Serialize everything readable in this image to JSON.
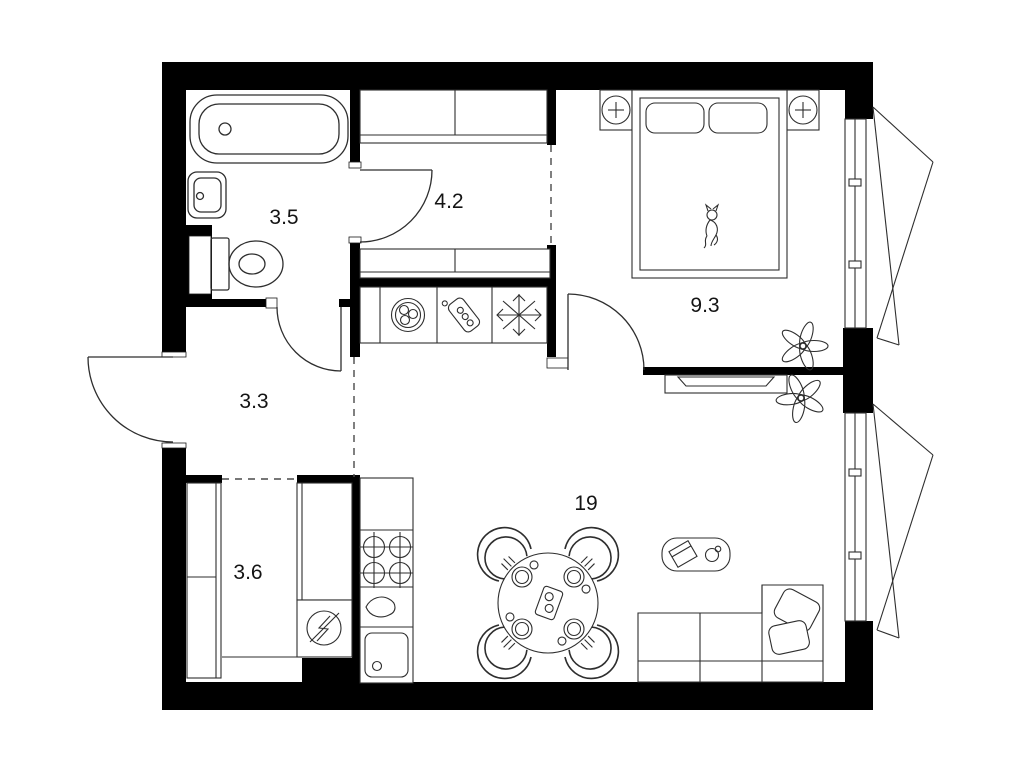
{
  "plan": {
    "title": "one-bedroom-apartment-floor-plan",
    "background_color": "#ffffff",
    "wall_color": "#000000",
    "line_color": "#2e2e2e",
    "rooms": [
      {
        "name": "bathroom",
        "area_label": "3.5"
      },
      {
        "name": "hallway",
        "area_label": "4.2"
      },
      {
        "name": "corridor",
        "area_label": "3.3"
      },
      {
        "name": "storage",
        "area_label": "3.6"
      },
      {
        "name": "bedroom",
        "area_label": "9.3"
      },
      {
        "name": "living-kitchen",
        "area_label": "19"
      }
    ],
    "icons": [
      "bathtub-icon",
      "washbasin-icon",
      "toilet-icon",
      "duct-shaft-icon",
      "wardrobe-icon",
      "washing-machine-icon",
      "water-heater-icon",
      "refrigerator-snowflake-icon",
      "stove-burners-icon",
      "kitchen-sink-icon",
      "teardrop-fixture-icon",
      "electric-panel-icon",
      "double-bed-icon",
      "pillow-icon",
      "cat-icon",
      "bedside-lamp-icon",
      "plant-icon",
      "tv-console-icon",
      "dining-table-icon",
      "chair-icon",
      "place-setting-icon",
      "serving-tray-icon",
      "coffee-table-icon",
      "book-icon",
      "cup-icon",
      "sofa-icon",
      "window-casement-icon",
      "door-swing-icon"
    ]
  }
}
